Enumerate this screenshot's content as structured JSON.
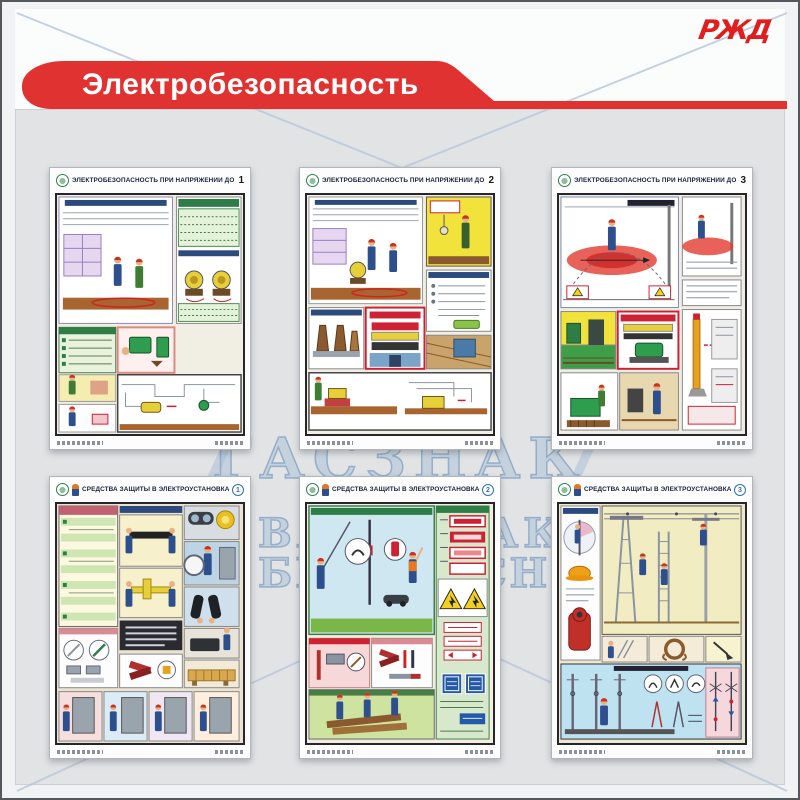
{
  "stand": {
    "brand": "РЖД",
    "title": "Электробезопасность",
    "watermark": {
      "line1": "ГАСЗНАК",
      "line2": "ВАШ ЗНАК",
      "line3": "БЕЗОПАСНОСТИ"
    },
    "colors": {
      "banner_red": "#e13232",
      "brand_red": "#e21d1d",
      "panel_grey": "#e1e3e5",
      "watermark_blue": "#a8bed6",
      "poster_number_blue": "#2f6fb4"
    }
  },
  "posters": [
    {
      "title": "ЭЛЕКТРОБЕЗОПАСНОСТЬ ПРИ НАПРЯЖЕНИИ ДО 1000 В",
      "number": "1"
    },
    {
      "title": "ЭЛЕКТРОБЕЗОПАСНОСТЬ ПРИ НАПРЯЖЕНИИ ДО 1000 В",
      "number": "2"
    },
    {
      "title": "ЭЛЕКТРОБЕЗОПАСНОСТЬ ПРИ НАПРЯЖЕНИИ ДО 1000 В",
      "number": "3"
    },
    {
      "title": "СРЕДСТВА ЗАЩИТЫ В ЭЛЕКТРОУСТАНОВКАХ",
      "number": "1"
    },
    {
      "title": "СРЕДСТВА ЗАЩИТЫ В ЭЛЕКТРОУСТАНОВКАХ",
      "number": "2"
    },
    {
      "title": "СРЕДСТВА ЗАЩИТЫ В ЭЛЕКТРОУСТАНОВКАХ",
      "number": "3"
    }
  ]
}
